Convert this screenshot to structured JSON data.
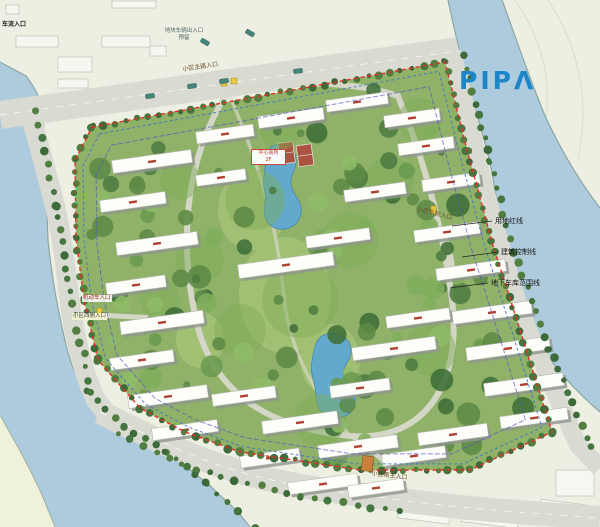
{
  "logo": {
    "text": "PIPΛ"
  },
  "legend": {
    "items": [
      {
        "label": "用地红线"
      },
      {
        "label": "建筑控制线"
      },
      {
        "label": "地下车库范围线"
      }
    ]
  },
  "labels": {
    "top_left_entrance": "车流入口",
    "north_note_line1": "地块车辆出入口",
    "north_note_line2": "预留",
    "main_entrance": "小区主路入口",
    "west_vehicle_entrance": "机动车入口",
    "west_entrance": "小区西侧入口",
    "east_entrance": "小区东侧入口",
    "south_entrance": "小区南主入口",
    "clubhouse_line1": "中心会所",
    "clubhouse_line2": "2F"
  },
  "colors": {
    "logo-blue": "#1b86c8",
    "boundary-red": "#e23026",
    "control-blue": "#3a6fd0",
    "garage-line": "#5050c8",
    "water": "#aecbdd",
    "road": "#d9dad2",
    "site-green": "#8fb268",
    "land": "#ecefe1"
  }
}
